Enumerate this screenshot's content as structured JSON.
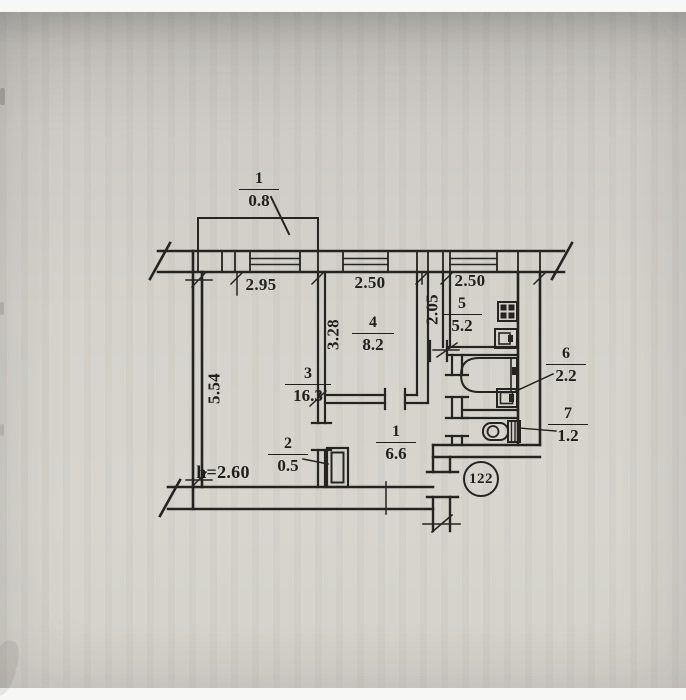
{
  "palette": {
    "paper": "#d6d3cd",
    "ink": "#211f1c"
  },
  "balcony": {
    "number": "1",
    "area": "0.8"
  },
  "rooms": {
    "living": {
      "number": "3",
      "area": "16.3"
    },
    "bedroom": {
      "number": "4",
      "area": "8.2"
    },
    "kitchen": {
      "number": "5",
      "area": "5.2"
    },
    "hallway": {
      "number": "1",
      "area": "6.6"
    },
    "closet": {
      "number": "2",
      "area": "0.5"
    },
    "bathroom": {
      "number": "6",
      "area": "2.2"
    },
    "wc": {
      "number": "7",
      "area": "1.2"
    }
  },
  "dimensions": {
    "top_living": "2.95",
    "top_bedroom": "2.50",
    "top_kitchen": "2.50",
    "left_wall": "5.54",
    "bedroom_depth": "3.28",
    "kitchen_depth": "2.05"
  },
  "notes": {
    "ceiling_height": "h=2.60",
    "apartment_number": "122"
  },
  "fixtures": {
    "stove": "stove-icon",
    "kitchen_sink": "kitchen-sink-icon",
    "bathtub": "bathtub-icon",
    "washbasin": "washbasin-icon",
    "toilet": "toilet-icon"
  }
}
